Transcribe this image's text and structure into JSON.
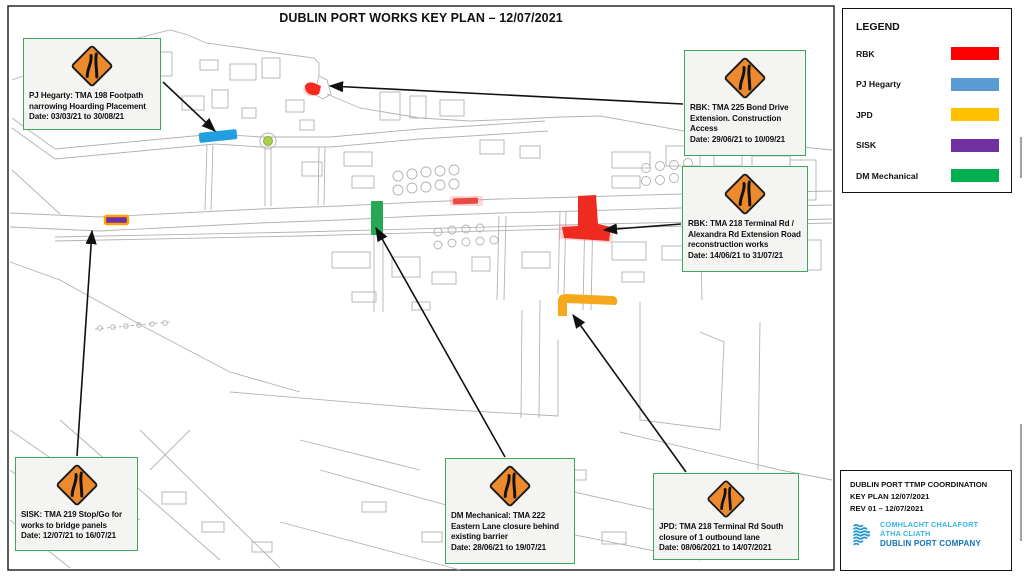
{
  "title": "DUBLIN PORT WORKS KEY PLAN – 12/07/2021",
  "legend": {
    "title": "LEGEND",
    "items": [
      {
        "label": "RBK",
        "color": "#FE0000"
      },
      {
        "label": "PJ Hegarty",
        "color": "#5B9BD5"
      },
      {
        "label": "JPD",
        "color": "#FFC000"
      },
      {
        "label": "SISK",
        "color": "#7030A0"
      },
      {
        "label": "DM Mechanical",
        "color": "#00B050"
      }
    ]
  },
  "callouts": [
    {
      "name": "pj-hegarty-tma-198",
      "lines": [
        "PJ Hegarty: TMA 198 Footpath",
        "narrowing Hoarding Placement",
        "Date: 03/03/21 to 30/08/21"
      ]
    },
    {
      "name": "rbk-tma-225",
      "lines": [
        "RBK: TMA 225 Bond Drive",
        "Extension. Construction",
        "Access",
        "Date: 29/06/21 to 10/09/21"
      ]
    },
    {
      "name": "rbk-tma-218",
      "lines": [
        "RBK: TMA 218 Terminal Rd /",
        "Alexandra Rd Extension Road",
        "reconstruction works",
        "Date: 14/06/21 to 31/07/21"
      ]
    },
    {
      "name": "sisk-tma-219",
      "lines": [
        "SISK: TMA 219 Stop/Go for",
        "works to bridge panels",
        "Date: 12/07/21 to 16/07/21"
      ]
    },
    {
      "name": "dm-mechanical-tma-222",
      "lines": [
        "DM Mechanical: TMA 222",
        "Eastern Lane closure behind",
        "existing barrier",
        "Date: 28/06/21 to 19/07/21"
      ]
    },
    {
      "name": "jpd-tma-218",
      "lines": [
        "JPD: TMA 218 Terminal Rd South",
        "closure of 1 outbound lane",
        "Date: 08/06/2021 to 14/07/2021"
      ]
    }
  ],
  "map": {
    "markings": {
      "pj_footpath": {
        "color": "#219FDE"
      },
      "rbk_bond_drive": {
        "color": "#FA291E"
      },
      "rbk_terminal_small": {
        "color": "#E94A3F"
      },
      "rbk_terminal_main": {
        "color": "#EE2A21"
      },
      "sisk_bridge": {
        "color": "#6F2DA8",
        "outline": "#FFA300"
      },
      "dm_eastern_lane": {
        "color": "#27A854"
      },
      "jpd_terminal_south": {
        "color": "#F6A81C"
      },
      "roundabout": {
        "color": "#A9D14E"
      }
    }
  },
  "colors": {
    "sign_orange": "#ED8A2D",
    "callout_border": "#3EA760"
  },
  "title_block": {
    "line1": "DUBLIN PORT TTMP COORDINATION",
    "line2": "KEY PLAN  12/07/2021",
    "line3": "REV 01 – 12/07/2021",
    "logo_line1": "COMHLACHT CHALAFORT",
    "logo_line2": "ÁTHA CLIATH",
    "logo_line3": "DUBLIN PORT COMPANY",
    "logo_light_blue": "#35B6E3",
    "logo_dark_blue": "#1272BA"
  }
}
